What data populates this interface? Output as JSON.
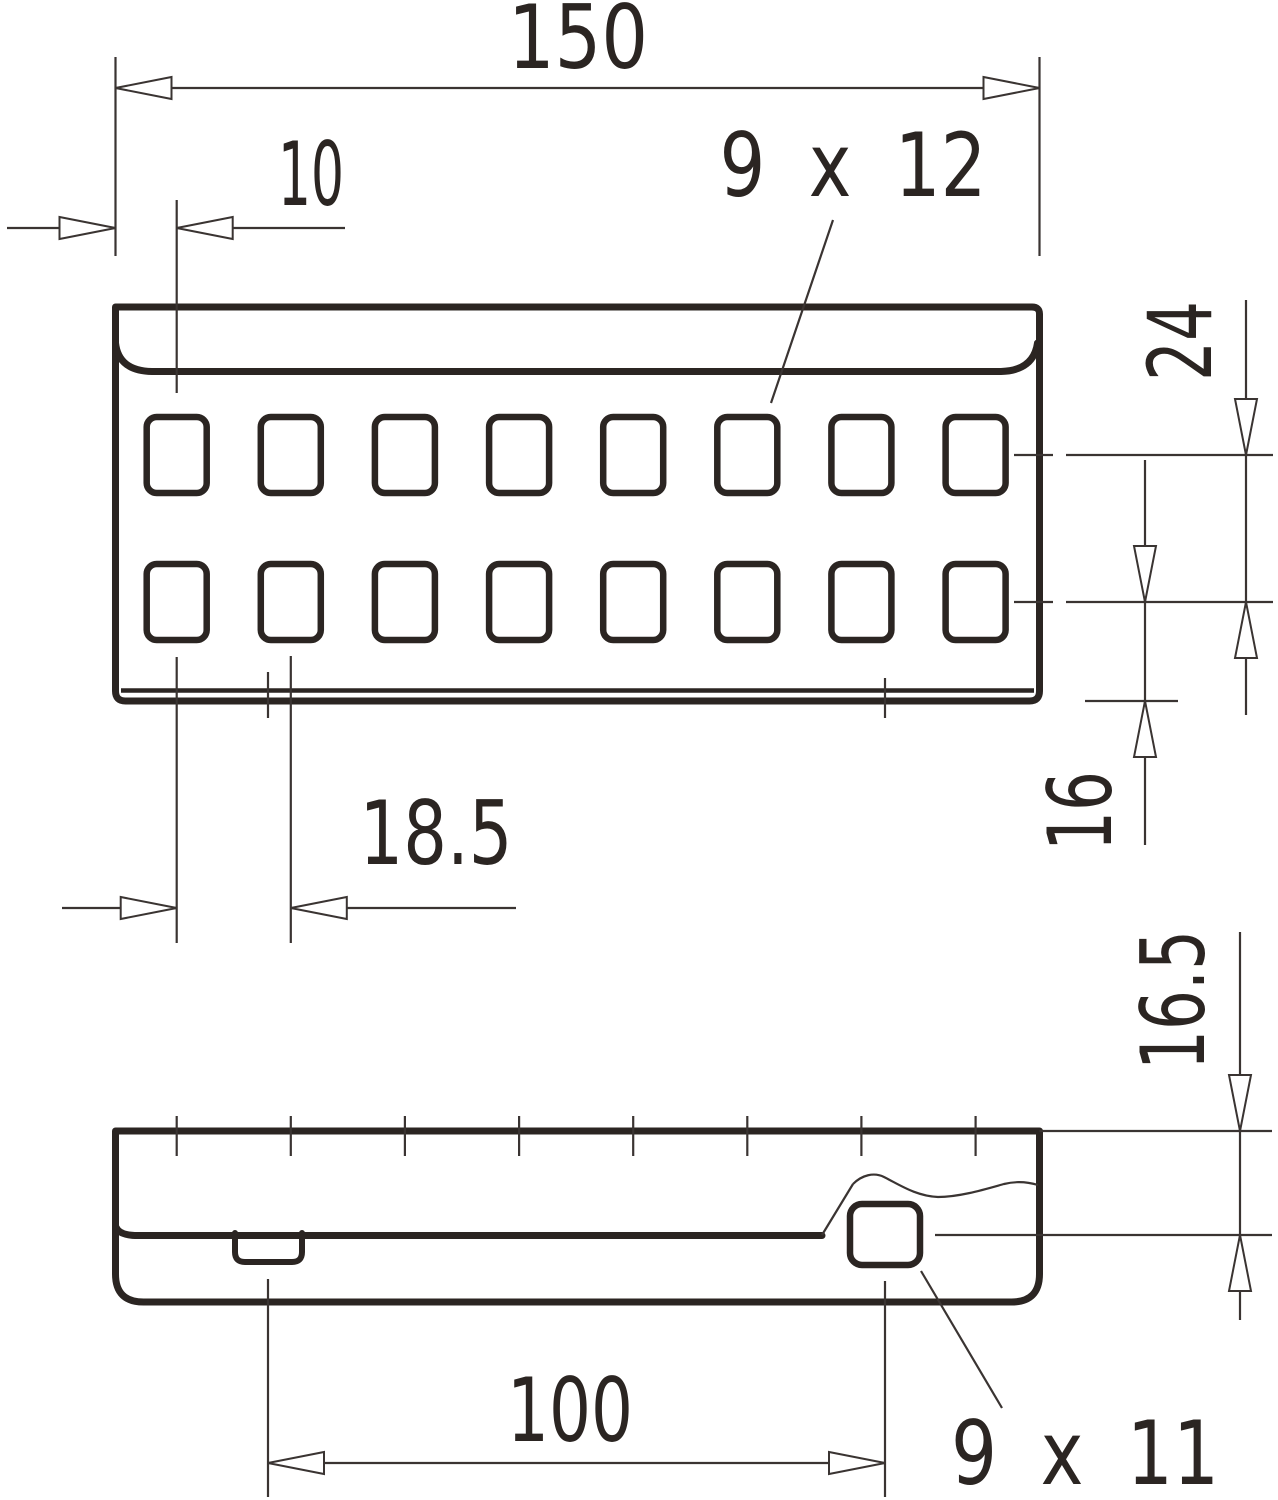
{
  "drawing": {
    "title": "perforated connector plate dimension drawing",
    "background_color": "#ffffff",
    "line_color": "#2b2522",
    "top_view": {
      "hole_rows": 2,
      "holes_per_row": 8,
      "labels": {
        "overall_length": "150",
        "edge_to_first_hole": "10",
        "hole_size": "9 x 12",
        "row_pitch": "24",
        "row_to_bottom_edge": "16",
        "hole_pitch": "18.5"
      }
    },
    "side_view": {
      "labels": {
        "step_height": "16.5",
        "slot_to_hole_distance": "100",
        "side_hole_size": "9 x 11"
      }
    }
  }
}
